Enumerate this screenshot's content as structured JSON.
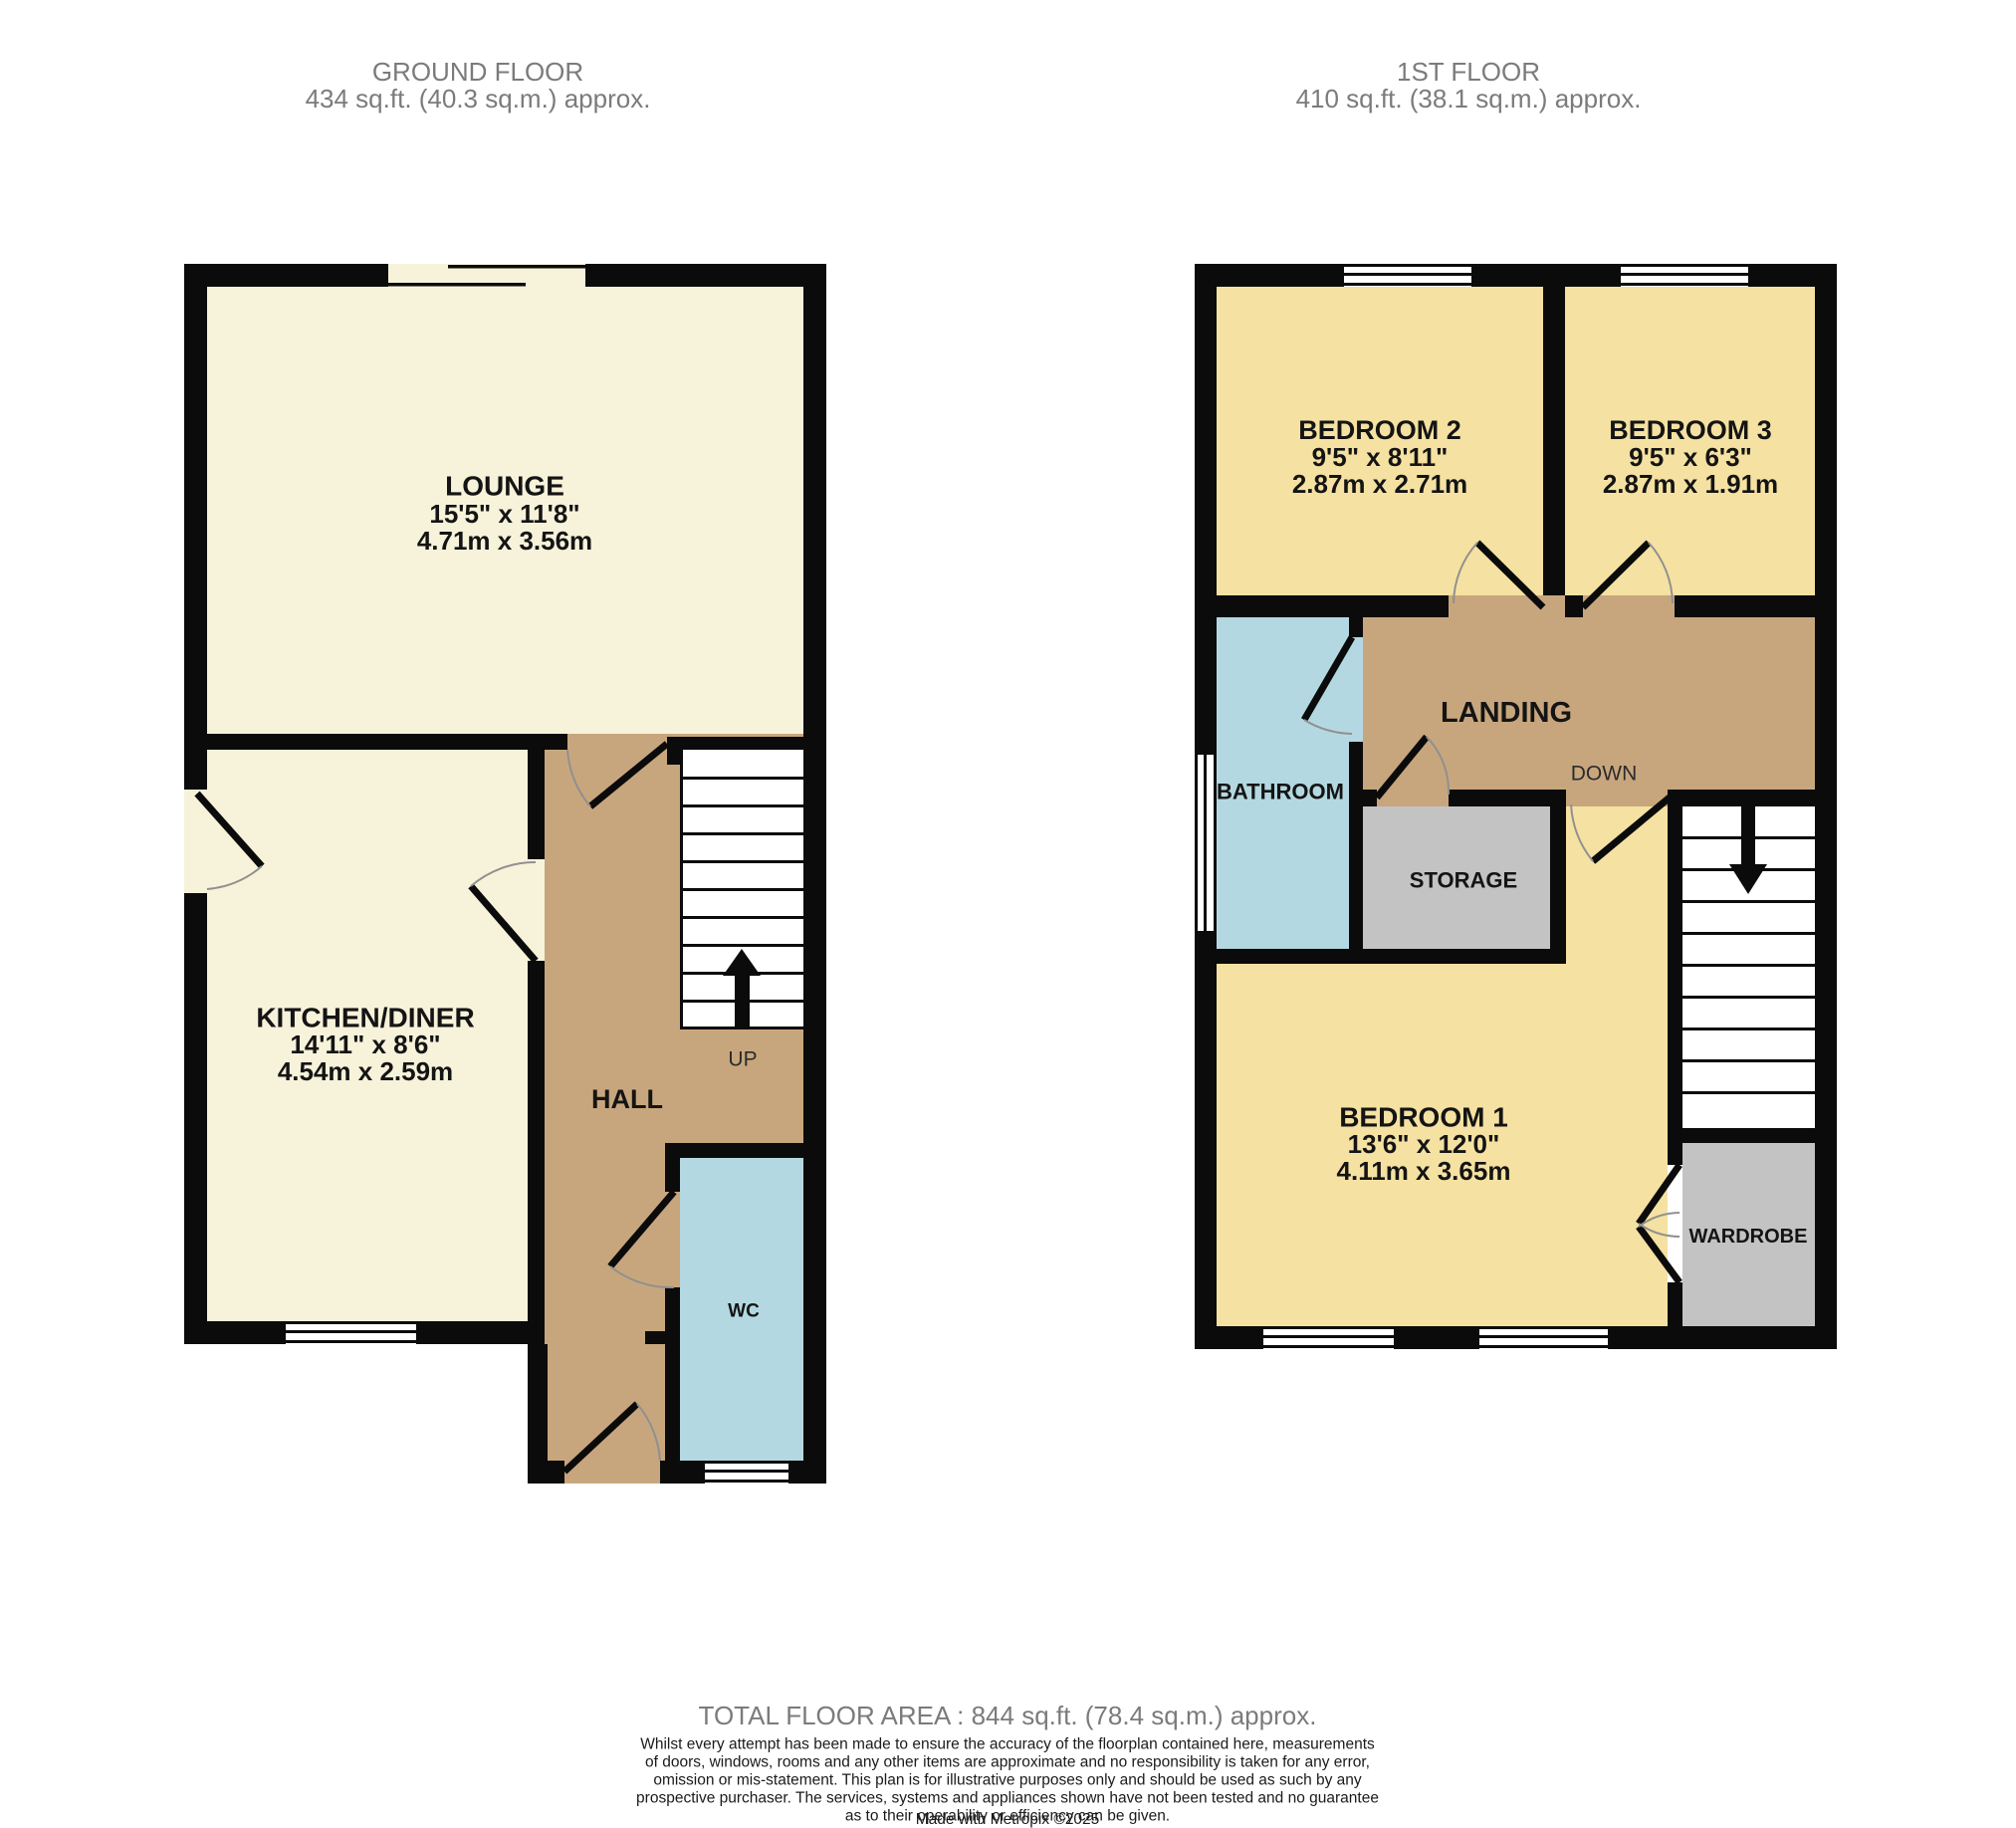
{
  "headers": {
    "ground_title": "GROUND FLOOR",
    "ground_area": "434 sq.ft. (40.3 sq.m.) approx.",
    "first_title": "1ST FLOOR",
    "first_area": "410 sq.ft. (38.1 sq.m.) approx."
  },
  "ground_floor": {
    "lounge_name": "LOUNGE",
    "lounge_imperial": "15'5\" x 11'8\"",
    "lounge_metric": "4.71m x 3.56m",
    "kitchen_name": "KITCHEN/DINER",
    "kitchen_imperial": "14'11\" x 8'6\"",
    "kitchen_metric": "4.54m x 2.59m",
    "hall_label": "HALL",
    "up_label": "UP",
    "wc_label": "WC"
  },
  "first_floor": {
    "bedroom2_name": "BEDROOM 2",
    "bedroom2_imperial": "9'5\" x 8'11\"",
    "bedroom2_metric": "2.87m x 2.71m",
    "bedroom3_name": "BEDROOM 3",
    "bedroom3_imperial": "9'5\" x 6'3\"",
    "bedroom3_metric": "2.87m x 1.91m",
    "bedroom1_name": "BEDROOM 1",
    "bedroom1_imperial": "13'6\" x 12'0\"",
    "bedroom1_metric": "4.11m x 3.65m",
    "bathroom_label": "BATHROOM",
    "landing_label": "LANDING",
    "down_label": "DOWN",
    "storage_label": "STORAGE",
    "wardrobe_label": "WARDROBE"
  },
  "footer": {
    "total": "TOTAL FLOOR AREA : 844 sq.ft. (78.4 sq.m.) approx.",
    "disclaimer_lines": [
      "Whilst every attempt has been made to ensure the accuracy of the floorplan contained here, measurements",
      "of doors, windows, rooms and any other items are approximate and no responsibility is taken for any error,",
      "omission or mis-statement. This plan is for illustrative purposes only and should be used as such by any",
      "prospective purchaser. The services, systems and appliances shown have not been tested and no guarantee",
      "as to their operability or efficiency can be given."
    ],
    "made_with": "Made with Metropix ©2025"
  },
  "colors": {
    "cream": "#f7f2da",
    "yellow": "#f5e1a1",
    "tan": "#c8a67d",
    "blue": "#b4d8e1",
    "gray": "#c3c3c3",
    "wall": "#0b0b0b",
    "arc": "#909090"
  }
}
